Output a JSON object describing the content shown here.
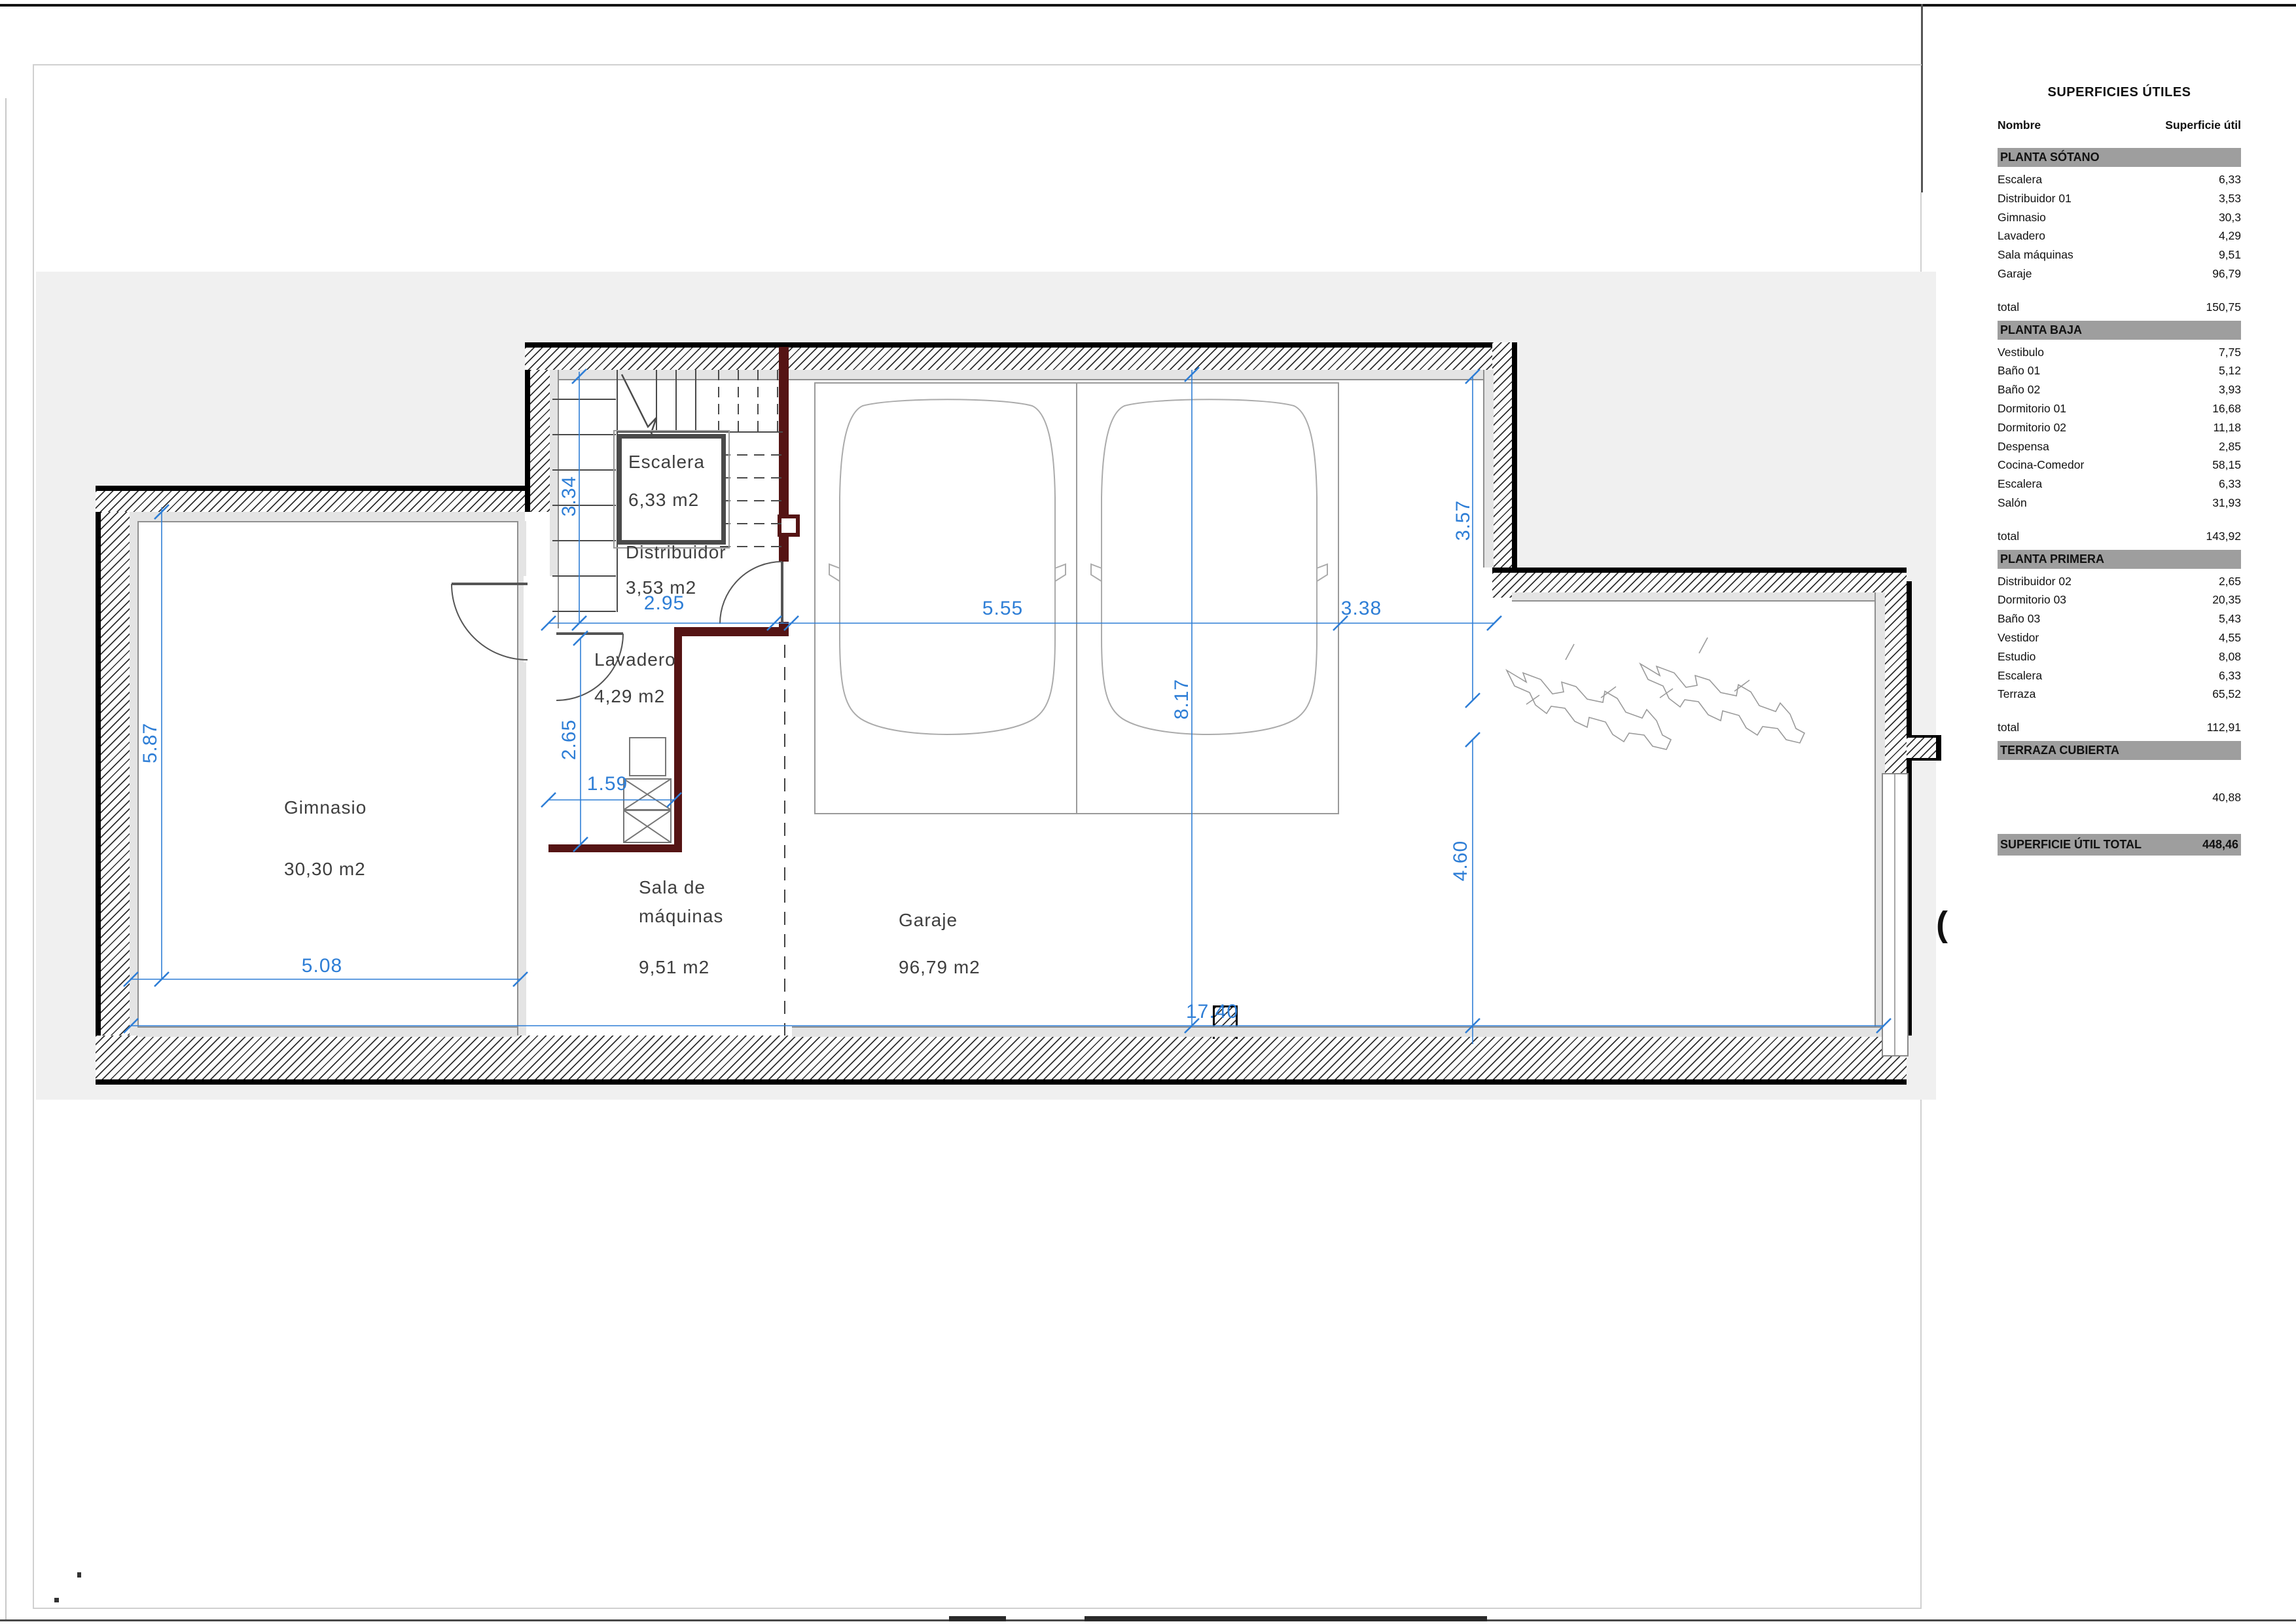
{
  "plan": {
    "rooms": {
      "escalera": {
        "name": "Escalera",
        "area": "6,33 m2"
      },
      "distribuidor": {
        "name": "Distribuidor",
        "area": "3,53 m2"
      },
      "lavadero": {
        "name": "Lavadero",
        "area": "4,29 m2"
      },
      "gimnasio": {
        "name": "Gimnasio",
        "area": "30,30 m2"
      },
      "sala": {
        "name": "Sala de\nmáquinas",
        "area": "9,51 m2"
      },
      "garaje": {
        "name": "Garaje",
        "area": "96,79 m2"
      }
    },
    "dims": {
      "v334": "3.34",
      "v295": "2.95",
      "v555": "5.55",
      "v338": "3.38",
      "v357": "3.57",
      "v817": "8.17",
      "v460": "4.60",
      "v587": "5.87",
      "v265": "2.65",
      "v159": "1.59",
      "v508": "5.08",
      "v1740": "17.40"
    },
    "misc": {
      "bracket": "("
    }
  },
  "colors": {
    "dim_blue": "#2e7ed6",
    "maroon_wall": "#551414",
    "band_gray": "#9e9e9e",
    "exterior_gray": "#f0f0f0"
  },
  "table": {
    "title": "SUPERFICIES ÚTILES",
    "col_name": "Nombre",
    "col_value": "Superficie útil",
    "total_label": "total",
    "sections": [
      {
        "header": "PLANTA SÓTANO",
        "rows": [
          [
            "Escalera",
            "6,33"
          ],
          [
            "Distribuidor 01",
            "3,53"
          ],
          [
            "Gimnasio",
            "30,3"
          ],
          [
            "Lavadero",
            "4,29"
          ],
          [
            "Sala máquinas",
            "9,51"
          ],
          [
            "Garaje",
            "96,79"
          ]
        ],
        "total": "150,75"
      },
      {
        "header": "PLANTA BAJA",
        "rows": [
          [
            "Vestibulo",
            "7,75"
          ],
          [
            "Baño 01",
            "5,12"
          ],
          [
            "Baño 02",
            "3,93"
          ],
          [
            "Dormitorio 01",
            "16,68"
          ],
          [
            "Dormitorio 02",
            "11,18"
          ],
          [
            "Despensa",
            "2,85"
          ],
          [
            "Cocina-Comedor",
            "58,15"
          ],
          [
            "Escalera",
            "6,33"
          ],
          [
            "Salón",
            "31,93"
          ]
        ],
        "total": "143,92"
      },
      {
        "header": "PLANTA PRIMERA",
        "rows": [
          [
            "Distribuidor 02",
            "2,65"
          ],
          [
            "Dormitorio 03",
            "20,35"
          ],
          [
            "Baño 03",
            "5,43"
          ],
          [
            "Vestidor",
            "4,55"
          ],
          [
            "Estudio",
            "8,08"
          ],
          [
            "Escalera",
            "6,33"
          ],
          [
            "Terraza",
            "65,52"
          ]
        ],
        "total": "112,91"
      },
      {
        "header": "TERRAZA CUBIERTA",
        "rows": [],
        "total": null,
        "extra": "40,88"
      }
    ],
    "grand": {
      "label": "SUPERFICIE ÚTIL TOTAL",
      "value": "448,46"
    }
  }
}
